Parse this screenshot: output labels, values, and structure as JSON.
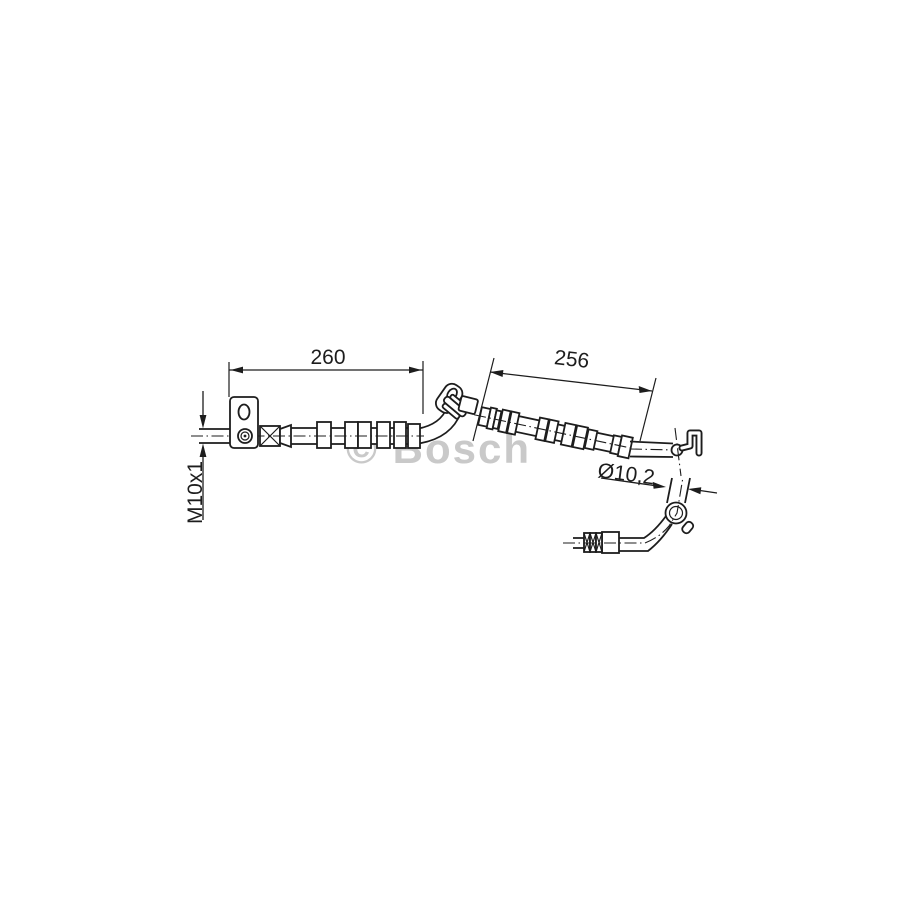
{
  "drawing": {
    "kind": "technical-line-drawing",
    "background": "#ffffff",
    "line_color": "#1d1d1d",
    "dimensions": {
      "length_main": "260",
      "length_secondary": "256",
      "thread": "M10x1",
      "diameter": "Ø10,2"
    },
    "watermark": {
      "text": "© Bosch",
      "color": "#c9c9c9"
    }
  }
}
